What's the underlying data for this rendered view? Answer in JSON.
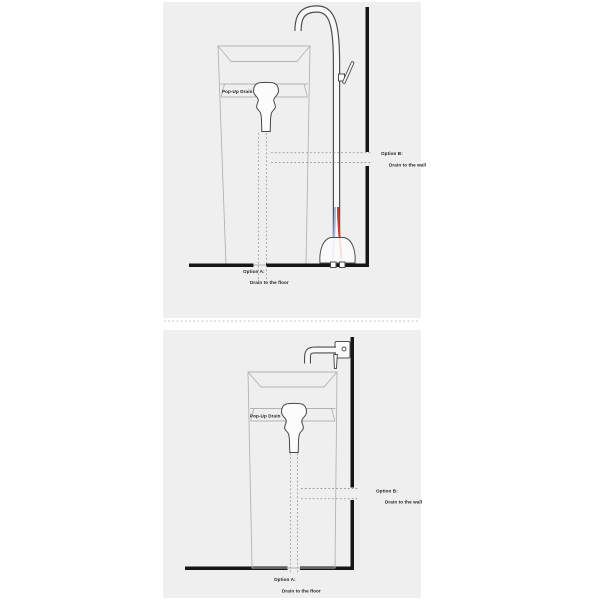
{
  "colors": {
    "page_bg": "#ffffff",
    "panel_bg": "#efefef",
    "sink_fill": "#f4f4f4",
    "structure_line": "#161616",
    "fixture_line": "#4f4f4f",
    "sink_line": "#b3b3b3",
    "dash_line": "#9c9c9c",
    "divider_dot": "#b8b8b8",
    "hot_hose": "#cf3b30",
    "cold_hose": "#9fb9e2",
    "label_text": "#1d1d1d"
  },
  "panels": [
    {
      "id": "freestanding-faucet-installation",
      "labels": {
        "popup_drain": "Pop-Up Drain",
        "option_a_title": "Option A:",
        "option_a_desc": "Drain to the floor",
        "option_b_title": "Option B:",
        "option_b_desc": "Drain to the wall"
      }
    },
    {
      "id": "wall-mounted-faucet-installation",
      "labels": {
        "popup_drain": "Pop-Up Drain",
        "option_a_title": "Option A:",
        "option_a_desc": "Drain to the floor",
        "option_b_title": "Option B:",
        "option_b_desc": "Drain to the wall"
      }
    }
  ]
}
